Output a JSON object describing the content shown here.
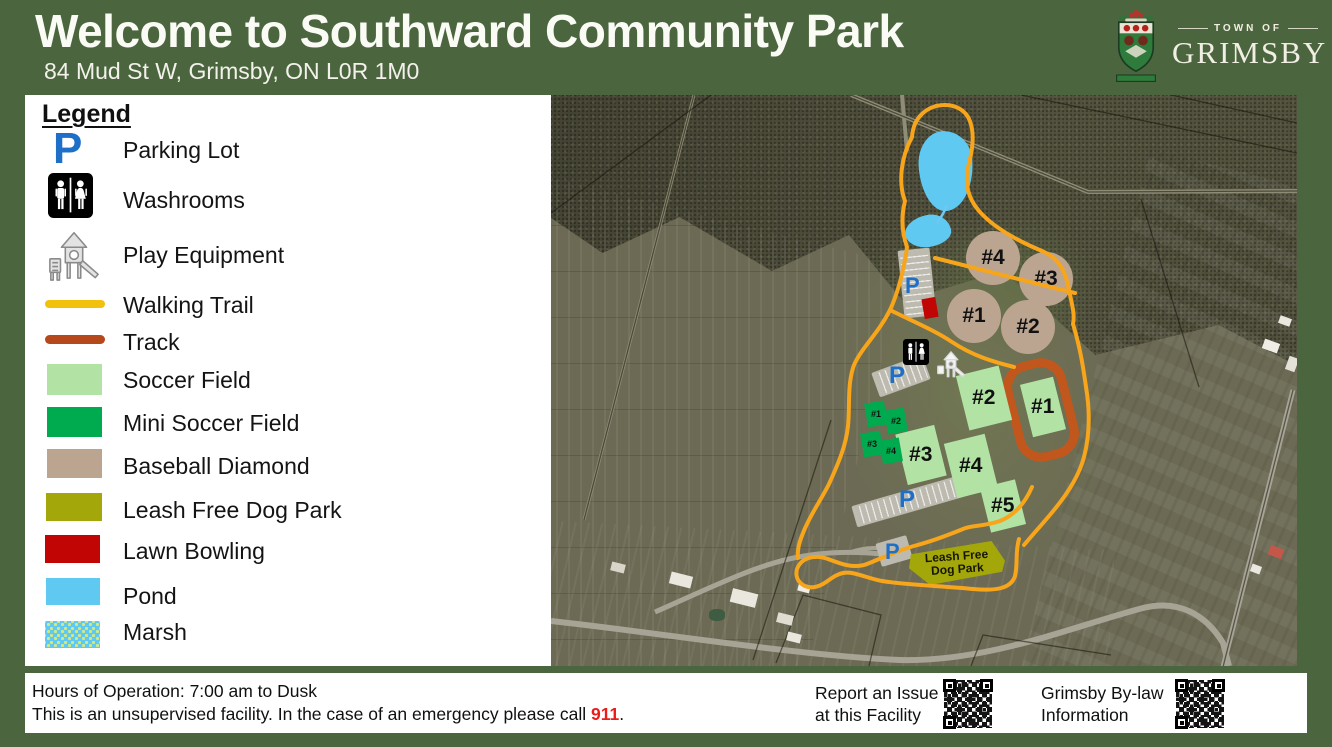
{
  "header": {
    "title": "Welcome to Southward Community Park",
    "address": "84 Mud St W, Grimsby, ON L0R 1M0",
    "logo_top": "TOWN OF",
    "logo_name": "GRIMSBY"
  },
  "legend": {
    "title": "Legend",
    "items": [
      {
        "id": "parking-lot",
        "label": "Parking Lot",
        "symbol": "P",
        "color": "#1D6FC8"
      },
      {
        "id": "washrooms",
        "label": "Washrooms"
      },
      {
        "id": "play-equipment",
        "label": "Play Equipment"
      },
      {
        "id": "walking-trail",
        "label": "Walking Trail",
        "color": "#F2C10D"
      },
      {
        "id": "track",
        "label": "Track",
        "color": "#B5491B"
      },
      {
        "id": "soccer-field",
        "label": "Soccer Field",
        "color": "#B2E3A4"
      },
      {
        "id": "mini-soccer-field",
        "label": "Mini Soccer Field",
        "color": "#00AB50"
      },
      {
        "id": "baseball-diamond",
        "label": "Baseball Diamond",
        "color": "#BCA590"
      },
      {
        "id": "leash-free-dog-park",
        "label": "Leash Free Dog Park",
        "color": "#A3A70A"
      },
      {
        "id": "lawn-bowling",
        "label": "Lawn Bowling",
        "color": "#C00504"
      },
      {
        "id": "pond",
        "label": "Pond",
        "color": "#5FC9F1"
      },
      {
        "id": "marsh",
        "label": "Marsh",
        "color": "#5FC9F1"
      }
    ]
  },
  "map": {
    "parking_symbol": "P",
    "baseball_diamonds": [
      {
        "label": "#4"
      },
      {
        "label": "#3"
      },
      {
        "label": "#1"
      },
      {
        "label": "#2"
      }
    ],
    "soccer_fields": [
      {
        "label": "#2"
      },
      {
        "label": "#1"
      },
      {
        "label": "#3"
      },
      {
        "label": "#4"
      },
      {
        "label": "#5"
      }
    ],
    "mini_soccer_fields": [
      {
        "label": "#1"
      },
      {
        "label": "#2"
      },
      {
        "label": "#3"
      },
      {
        "label": "#4"
      }
    ],
    "dog_park": {
      "line1": "Leash Free",
      "line2": "Dog Park"
    },
    "colors": {
      "trail": "#F7A51B",
      "track": "#C2571D",
      "soccer": "#B2E3A4",
      "mini_soccer": "#00AB50",
      "baseball": "#BCA590",
      "dog_park": "#A3A70A",
      "lawn_bowling": "#C00504",
      "pond": "#5FC9F1",
      "parking_letter": "#1D6FC8"
    }
  },
  "footer": {
    "hours_line": "Hours of Operation: 7:00 am to Dusk",
    "facility_line_pre": "This is an unsupervised facility. In the case of an emergency please call ",
    "emergency_number": "911",
    "facility_line_post": ".",
    "report_issue": {
      "line1": "Report an Issue",
      "line2": "at this Facility"
    },
    "bylaw": {
      "line1": "Grimsby By-law",
      "line2": "Information"
    }
  }
}
